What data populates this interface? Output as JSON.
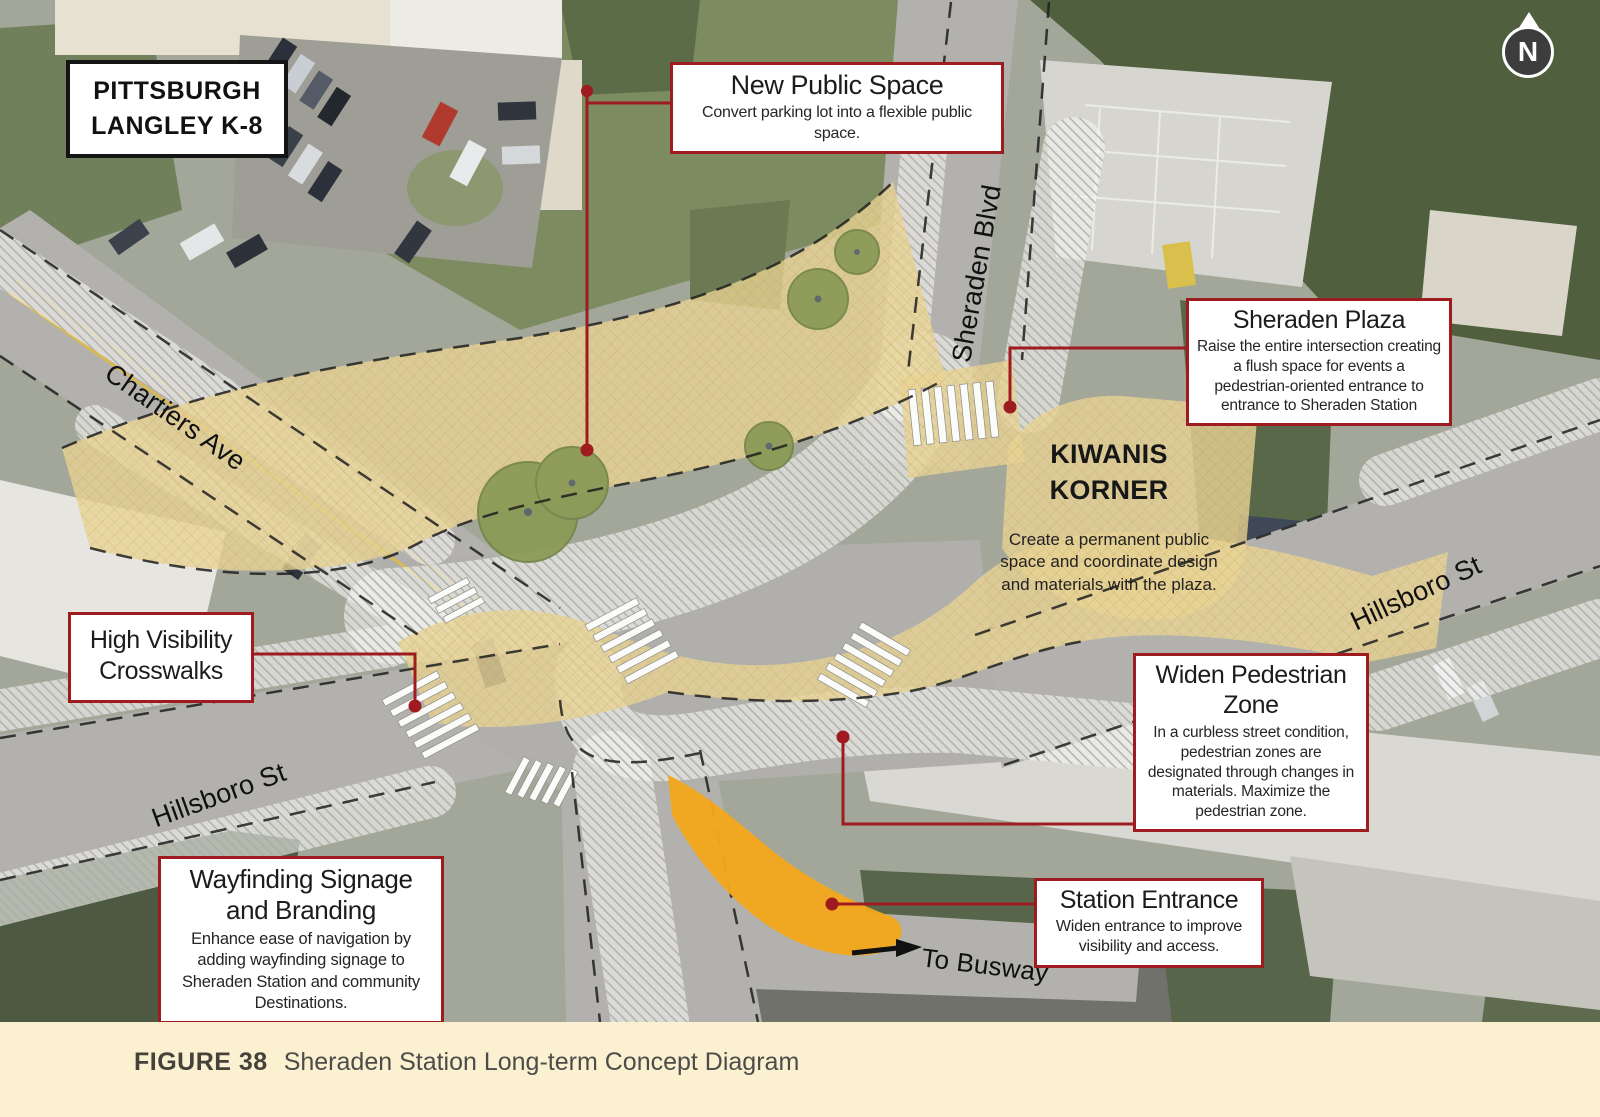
{
  "map": {
    "school": {
      "line1": "PITTSBURGH",
      "line2": "LANGLEY K-8"
    },
    "streets": {
      "chartiers": "Chartiers Ave",
      "sheraden_blvd": "Sheraden Blvd",
      "hillsboro_left": "Hillsboro St",
      "hillsboro_right": "Hillsboro St",
      "to_busway": "To Busway"
    },
    "north_label": "N",
    "kiwanis": {
      "line1": "KIWANIS",
      "line2": "KORNER",
      "body": "Create a permanent public space and coordinate design and materials with the plaza."
    }
  },
  "callouts": [
    {
      "id": "new-public-space",
      "title": "New Public Space",
      "body": "Convert parking lot into a flexible public space."
    },
    {
      "id": "sheraden-plaza",
      "title": "Sheraden Plaza",
      "body": "Raise the entire intersection creating a flush space for events a pedestrian-oriented entrance to entrance to Sheraden Station"
    },
    {
      "id": "high-visibility-crosswalks",
      "title": "High Visibility Crosswalks",
      "body": ""
    },
    {
      "id": "widen-pedestrian-zone",
      "title": "Widen Pedestrian Zone",
      "body": "In a curbless street condition, pedestrian zones are designated through changes in materials. Maximize the pedestrian zone."
    },
    {
      "id": "wayfinding-signage",
      "title": "Wayfinding Signage and Branding",
      "body": "Enhance ease of navigation by adding wayfinding signage to Sheraden Station and community Destinations."
    },
    {
      "id": "station-entrance",
      "title": "Station Entrance",
      "body": "Widen entrance to improve visibility and access."
    }
  ],
  "caption": {
    "label": "FIGURE 38",
    "text": "Sheraden Station Long-term Concept Diagram"
  },
  "colors": {
    "accent_red": "#9e1b20",
    "plaza_tan": "#e9d394",
    "entrance_orange": "#f2a81d",
    "tree_green": "#8a9a55",
    "caption_band": "#fbf1d1"
  }
}
